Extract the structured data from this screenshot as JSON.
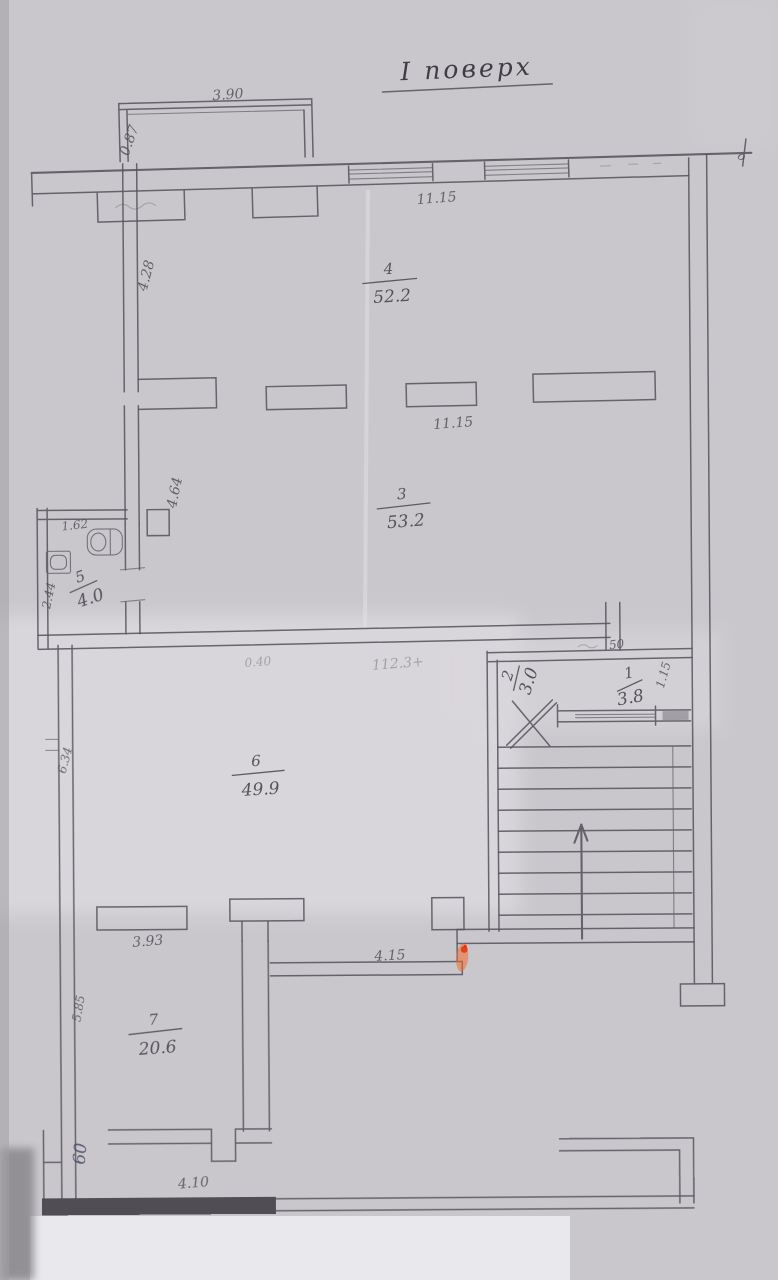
{
  "title": {
    "text": "I поверх"
  },
  "rooms": [
    {
      "number": "4",
      "area": "52.2"
    },
    {
      "number": "3",
      "area": "53.2"
    },
    {
      "number": "5",
      "area": "4.0"
    },
    {
      "number": "2",
      "area": "3.0"
    },
    {
      "number": "1",
      "area": "3.8"
    },
    {
      "number": "6",
      "area": "49.9"
    },
    {
      "number": "7",
      "area": "20.6"
    }
  ],
  "dimensions": {
    "balcony_width": "3.90",
    "balcony_depth": "0.87",
    "top_window_run": "11.15",
    "room4_left": "4.28",
    "mid_wall_run": "11.15",
    "room3_left": "4.64",
    "wc_width": "1.62",
    "wc_left": "2.44",
    "faint_a": "0.40",
    "faint_b": "112.3+",
    "stub_offset": "50",
    "entry_right": "1.15",
    "room6_left": "6.34",
    "room7_width": "3.93",
    "corridor_width": "4.15",
    "room7_left": "5.85",
    "lobby_width": "4.10",
    "axis_mark": "o",
    "ink_note": "60"
  }
}
